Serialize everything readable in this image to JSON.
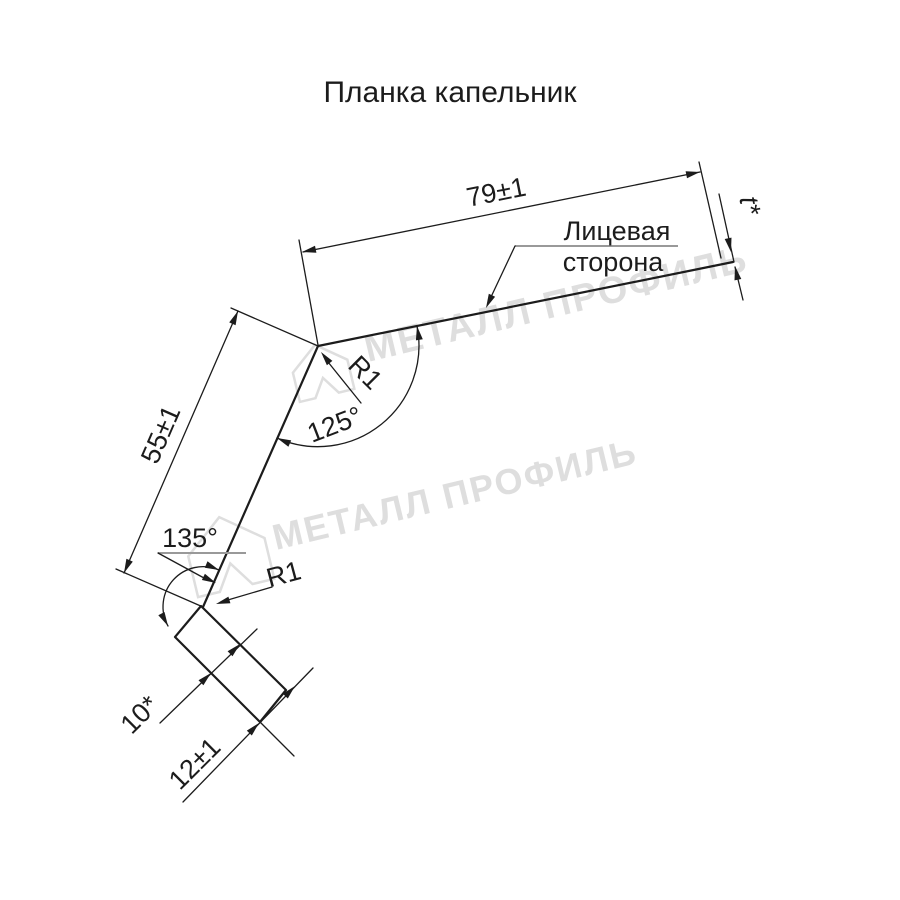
{
  "page": {
    "title": "Планка капельник"
  },
  "drawing": {
    "part_name": "Планка капельник",
    "dimensions": {
      "top_width": "79±1",
      "thickness": "t*",
      "leg_height": "55±1",
      "hem_depth": "10*",
      "hem_overall": "12±1"
    },
    "angles": {
      "top_bend": "125°",
      "bottom_bend": "135°"
    },
    "radii": {
      "top_bend": "R1",
      "bottom_bend": "R1"
    },
    "face_side": {
      "line1": "Лицевая",
      "line2": "сторона"
    }
  },
  "watermark": {
    "text": "МЕТАЛЛ ПРОФИЛЬ"
  },
  "colors": {
    "line": "#1c1c1c",
    "leader_underline": "#999999",
    "watermark": "#dedede"
  }
}
